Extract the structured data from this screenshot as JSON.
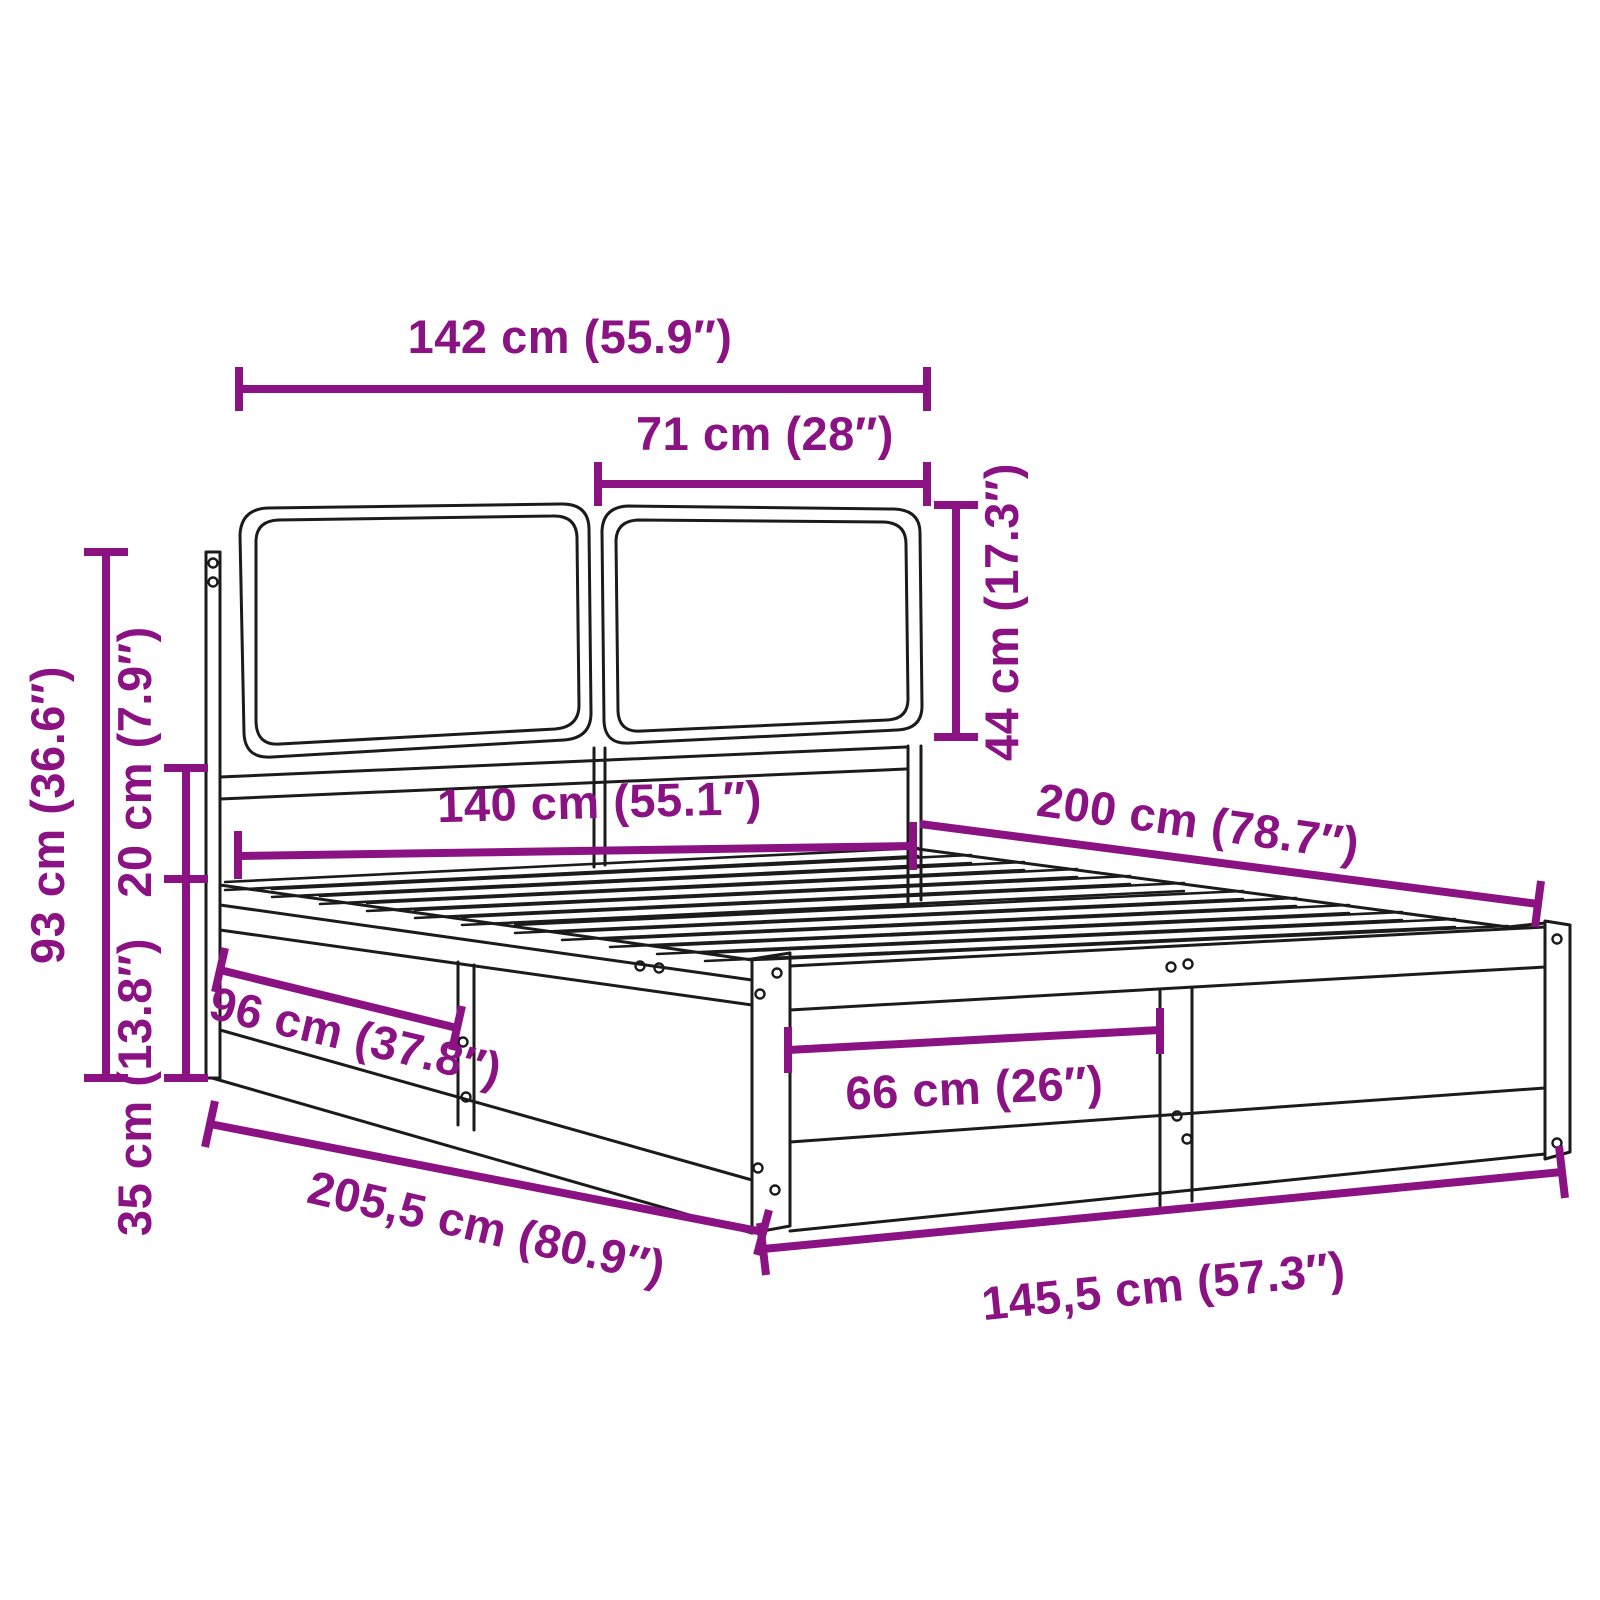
{
  "diagram": {
    "type": "product-dimension-diagram",
    "subject": "bed frame with two headboard cushions and slatted base",
    "background_color": "#ffffff",
    "outline_color": "#1b1b1b",
    "dimension_color": "#8B1282"
  },
  "dimensions": {
    "headboard_width": {
      "label": "142 cm (55.9″)"
    },
    "cushion_width": {
      "label": "71 cm (28″)"
    },
    "cushion_height": {
      "label": "44 cm (17.3″)"
    },
    "headboard_total_height": {
      "label": "93 cm (36.6″)"
    },
    "rail_gap_height": {
      "label": "20 cm (7.9″)"
    },
    "frame_height": {
      "label": "35 cm (13.8″)"
    },
    "mattress_width": {
      "label": "140 cm (55.1″)"
    },
    "mattress_length": {
      "label": "200 cm (78.7″)"
    },
    "side_opening": {
      "label": "96 cm (37.8″)"
    },
    "foot_opening": {
      "label": "66 cm (26″)"
    },
    "total_length": {
      "label": "205,5 cm (80.9″)"
    },
    "total_width": {
      "label": "145,5 cm (57.3″)"
    }
  }
}
